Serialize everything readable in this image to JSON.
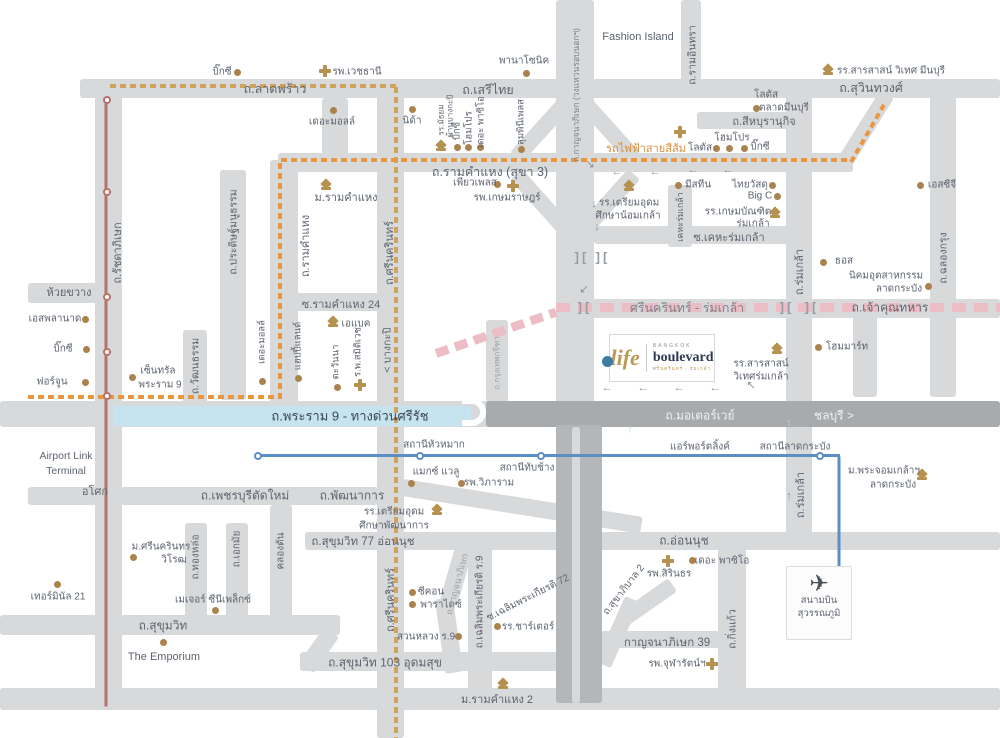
{
  "title": "Life Bangkok Boulevard Srinakarin-Romklao location map",
  "logo": {
    "brand_script": "life",
    "brand_city": "BANGKOK",
    "brand_name": "boulevard",
    "brand_sub": "ศรีนครินทร์ - ร่มเกล้า"
  },
  "airport": {
    "line1": "สนามบิน",
    "line2": "สุวรรณภูมิ",
    "plane_icon": "✈"
  },
  "palette": {
    "road": "#d8d9da",
    "roadDark": "#a7abad",
    "roadMid": "#b3b7b9",
    "hl": "#c5e4ef",
    "text": "#5d6470",
    "textLight": "#9aa0a6",
    "gold": "#a9824c",
    "icon": "#b5924f",
    "red": "#b5736b",
    "blue": "#5b8ec4",
    "yellow": "#cfa45f",
    "orange": "#e8963f",
    "pink": "#ecbdc4",
    "white": "#f0f1f2",
    "navy": "#2f3a50",
    "marker": "#3e7ca6"
  },
  "roads": [
    [
      80,
      79,
      920,
      19
    ],
    [
      681,
      0,
      20,
      88
    ],
    [
      858,
      88,
      16,
      80,
      32
    ],
    [
      697,
      112,
      108,
      17
    ],
    [
      556,
      0,
      38,
      430
    ],
    [
      532,
      95,
      16,
      72,
      42
    ],
    [
      602,
      95,
      16,
      72,
      -42
    ],
    [
      532,
      165,
      16,
      72,
      -42
    ],
    [
      602,
      165,
      16,
      72,
      42
    ],
    [
      278,
      153,
      575,
      19
    ],
    [
      95,
      79,
      27,
      631
    ],
    [
      220,
      170,
      26,
      230
    ],
    [
      183,
      330,
      24,
      73
    ],
    [
      270,
      160,
      28,
      243
    ],
    [
      377,
      79,
      27,
      659
    ],
    [
      28,
      283,
      82,
      20
    ],
    [
      284,
      293,
      110,
      18
    ],
    [
      322,
      98,
      26,
      58
    ],
    [
      594,
      226,
      212,
      18
    ],
    [
      668,
      185,
      24,
      62
    ],
    [
      786,
      95,
      26,
      450
    ],
    [
      930,
      95,
      26,
      302
    ],
    [
      853,
      315,
      24,
      82
    ],
    [
      556,
      299,
      444,
      19
    ],
    [
      486,
      320,
      22,
      82
    ],
    [
      0,
      401,
      505,
      26
    ],
    [
      28,
      487,
      350,
      18
    ],
    [
      390,
      497,
      253,
      17,
      9
    ],
    [
      305,
      532,
      695,
      18
    ],
    [
      185,
      523,
      22,
      108
    ],
    [
      226,
      523,
      22,
      108
    ],
    [
      270,
      505,
      22,
      126
    ],
    [
      0,
      615,
      340,
      20
    ],
    [
      310,
      628,
      18,
      44,
      35
    ],
    [
      300,
      652,
      262,
      19
    ],
    [
      468,
      545,
      24,
      150
    ],
    [
      448,
      542,
      18,
      62,
      16
    ],
    [
      440,
      598,
      18,
      75,
      -8
    ],
    [
      718,
      548,
      28,
      160
    ],
    [
      600,
      631,
      128,
      17
    ],
    [
      610,
      596,
      16,
      72,
      24
    ],
    [
      640,
      572,
      16,
      60,
      55
    ],
    [
      0,
      688,
      1000,
      22
    ],
    [
      486,
      401,
      514,
      26,
      0,
      "roadDark"
    ],
    [
      556,
      425,
      46,
      278,
      0,
      "roadMid"
    ],
    [
      572,
      427,
      8,
      276,
      0,
      "road"
    ],
    [
      113,
      406,
      358,
      20,
      0,
      "hl"
    ]
  ],
  "dashes": [
    {
      "x": 110,
      "y": 84,
      "len": 287,
      "rot": 0,
      "col": "yellow",
      "t": 4,
      "dash": 6,
      "gap": 4
    },
    {
      "x": 396,
      "y": 85,
      "len": 651,
      "rot": 90,
      "col": "yellow",
      "t": 4,
      "dash": 6,
      "gap": 4
    },
    {
      "x": 28,
      "y": 395,
      "len": 252,
      "rot": 0,
      "col": "orange",
      "t": 4,
      "dash": 6,
      "gap": 4
    },
    {
      "x": 280,
      "y": 161,
      "len": 237,
      "rot": 90,
      "col": "orange",
      "t": 4,
      "dash": 6,
      "gap": 4
    },
    {
      "x": 281,
      "y": 158,
      "len": 570,
      "rot": 0,
      "col": "orange",
      "t": 4,
      "dash": 6,
      "gap": 4
    },
    {
      "x": 851,
      "y": 160,
      "len": 70,
      "rot": -60,
      "col": "orange",
      "t": 4,
      "dash": 6,
      "gap": 4
    },
    {
      "x": 556,
      "y": 303,
      "len": 444,
      "rot": 0,
      "col": "pink",
      "t": 9,
      "dash": 14,
      "gap": 8
    },
    {
      "x": 436,
      "y": 349,
      "len": 127,
      "rot": -19,
      "col": "pink",
      "t": 9,
      "dash": 13,
      "gap": 7
    }
  ],
  "solids": [
    {
      "x": 106,
      "y": 97,
      "len": 608,
      "rot": 90,
      "col": "red",
      "t": 3
    },
    {
      "x": 258,
      "y": 454,
      "len": 582,
      "rot": 0,
      "col": "blue",
      "t": 3
    },
    {
      "x": 839,
      "y": 455,
      "len": 127,
      "rot": 90,
      "col": "blue",
      "t": 3
    }
  ],
  "stations": [
    {
      "x": 107,
      "y": 100,
      "col": "red"
    },
    {
      "x": 107,
      "y": 192,
      "col": "red"
    },
    {
      "x": 107,
      "y": 297,
      "col": "red"
    },
    {
      "x": 107,
      "y": 352,
      "col": "red"
    },
    {
      "x": 107,
      "y": 396,
      "col": "red"
    },
    {
      "x": 258,
      "y": 456,
      "col": "blue"
    },
    {
      "x": 420,
      "y": 456,
      "col": "blue"
    },
    {
      "x": 541,
      "y": 456,
      "col": "blue"
    },
    {
      "x": 820,
      "y": 456,
      "col": "blue"
    },
    {
      "x": 840,
      "y": 581,
      "col": "blue"
    }
  ],
  "dots": [
    [
      237,
      72
    ],
    [
      526,
      73
    ],
    [
      333,
      110
    ],
    [
      412,
      109
    ],
    [
      756,
      108
    ],
    [
      716,
      148
    ],
    [
      729,
      148
    ],
    [
      744,
      148
    ],
    [
      678,
      185
    ],
    [
      772,
      185
    ],
    [
      777,
      196
    ],
    [
      920,
      185
    ],
    [
      497,
      184
    ],
    [
      823,
      262
    ],
    [
      928,
      286
    ],
    [
      818,
      347
    ],
    [
      262,
      381
    ],
    [
      298,
      378
    ],
    [
      337,
      387
    ],
    [
      85,
      319
    ],
    [
      86,
      349
    ],
    [
      85,
      382
    ],
    [
      132,
      377
    ],
    [
      133,
      557
    ],
    [
      215,
      610
    ],
    [
      57,
      584
    ],
    [
      163,
      642
    ],
    [
      412,
      592
    ],
    [
      412,
      604
    ],
    [
      458,
      636
    ],
    [
      497,
      626
    ],
    [
      692,
      560
    ],
    [
      457,
      147
    ],
    [
      468,
      147
    ],
    [
      480,
      147
    ],
    [
      521,
      149
    ],
    [
      411,
      483
    ],
    [
      461,
      483
    ]
  ],
  "crosses": [
    [
      325,
      71
    ],
    [
      680,
      132
    ],
    [
      513,
      186
    ],
    [
      360,
      385
    ],
    [
      668,
      561
    ],
    [
      712,
      664
    ]
  ],
  "caps": [
    [
      326,
      186
    ],
    [
      629,
      187
    ],
    [
      775,
      214
    ],
    [
      441,
      147
    ],
    [
      333,
      323
    ],
    [
      828,
      71
    ],
    [
      777,
      350
    ],
    [
      922,
      476
    ],
    [
      437,
      511
    ],
    [
      503,
      685
    ]
  ],
  "arrows": [
    {
      "x": 617,
      "y": 172,
      "g": "←"
    },
    {
      "x": 655,
      "y": 172,
      "g": "←"
    },
    {
      "x": 693,
      "y": 170,
      "g": "←"
    },
    {
      "x": 728,
      "y": 170,
      "g": "←"
    },
    {
      "x": 590,
      "y": 164,
      "g": "↘"
    },
    {
      "x": 594,
      "y": 204,
      "g": "↓"
    },
    {
      "x": 597,
      "y": 227,
      "g": "↓"
    },
    {
      "x": 584,
      "y": 289,
      "g": "↙"
    },
    {
      "x": 607,
      "y": 388,
      "g": "←"
    },
    {
      "x": 643,
      "y": 388,
      "g": "←"
    },
    {
      "x": 679,
      "y": 388,
      "g": "←"
    },
    {
      "x": 715,
      "y": 388,
      "g": "←"
    },
    {
      "x": 751,
      "y": 385,
      "g": "↖"
    },
    {
      "x": 789,
      "y": 423,
      "g": "↑",
      "light": true
    },
    {
      "x": 630,
      "y": 429,
      "g": "↑",
      "light": true
    },
    {
      "x": 789,
      "y": 496,
      "g": "↑"
    }
  ],
  "brackets": [
    [
      582,
      257
    ],
    [
      603,
      257
    ],
    [
      585,
      307
    ],
    [
      787,
      307
    ],
    [
      812,
      307
    ]
  ],
  "uturn": {
    "x": 462,
    "y": 398,
    "w": 24,
    "h": 28
  },
  "marker": {
    "x": 607,
    "y": 361
  },
  "labels": [
    [
      "บิ๊กซี",
      222,
      72
    ],
    [
      "รพ.เวชธานี",
      357,
      72
    ],
    [
      "พานาโซนิค",
      524,
      61
    ],
    [
      "ถ.ลาดพร้าว",
      275,
      89,
      {
        "s": 12.5
      }
    ],
    [
      "ถ.เสรีไทย",
      488,
      90,
      {
        "s": 12.5
      }
    ],
    [
      "Fashion Island",
      638,
      37,
      {
        "s": 11
      }
    ],
    [
      "รร.สารสาสน์ วิเทศ มีนบุรี",
      891,
      71
    ],
    [
      "ถ.สุวินทวงศ์",
      871,
      88,
      {
        "s": 12.5
      }
    ],
    [
      "เดอะมอลล์",
      332,
      122
    ],
    [
      "นิด้า",
      412,
      121
    ],
    [
      "โลตัส",
      766,
      95
    ],
    [
      "ตลาดมีนบุรี",
      784,
      108
    ],
    [
      "ถ.สีหบุรานุกิจ",
      764,
      121,
      {
        "s": 11
      }
    ],
    [
      "โฮมโปร",
      732,
      138
    ],
    [
      "โลตัส",
      700,
      148
    ],
    [
      "บิ๊กซี",
      760,
      147
    ],
    [
      "รถไฟฟ้าสายสีส้ม",
      646,
      148,
      {
        "c": "#d98f3f",
        "s": 11
      }
    ],
    [
      "มีสทีน",
      698,
      185
    ],
    [
      "ไทยวัสดุ",
      750,
      185
    ],
    [
      "Big C",
      760,
      196
    ],
    [
      "เอสซีจี",
      942,
      185
    ],
    [
      "ถ.รามคำแหง (สุขา 3)",
      490,
      172,
      {
        "s": 12.5
      }
    ],
    [
      "เพียวเพลส",
      475,
      183
    ],
    [
      "รพ.เกษมราษฎร์",
      507,
      198
    ],
    [
      "ม.รามคำแหง",
      346,
      197,
      {
        "s": 11
      }
    ],
    [
      "รร.เตรียมอุดม",
      629,
      203
    ],
    [
      "ศึกษาน้อมเกล้า",
      628,
      216
    ],
    [
      "รร.เกษมบัณฑิต",
      738,
      212
    ],
    [
      "ร่มเกล้า",
      753,
      224
    ],
    [
      "ซ.เคหะร่มเกล้า",
      729,
      237,
      {
        "s": 11
      }
    ],
    [
      "ธอส",
      844,
      261
    ],
    [
      "นิคมอุตสาหกรรม",
      886,
      276
    ],
    [
      "ลาดกระบัง",
      899,
      289
    ],
    [
      "ห้วยขวาง",
      69,
      292,
      {
        "s": 11
      }
    ],
    [
      "ซ.รามคำแหง 24",
      341,
      304,
      {
        "s": 11
      }
    ],
    [
      "ศรีนครินทร์ - ร่มเกล้า",
      687,
      308,
      {
        "s": 12.5,
        "c": "#7d838c"
      }
    ],
    [
      "ถ.เจ้าคุณทหาร",
      890,
      308,
      {
        "s": 12
      }
    ],
    [
      "เอแบค",
      356,
      324
    ],
    [
      "เอสพลานาด",
      55,
      319
    ],
    [
      "บิ๊กซี",
      63,
      349
    ],
    [
      "ฟอร์จูน",
      52,
      382
    ],
    [
      "เซ็นทรัล",
      158,
      371
    ],
    [
      "พระราม 9",
      160,
      385
    ],
    [
      "โฮมมาร์ท",
      847,
      347
    ],
    [
      "รร.สารสาสน์",
      761,
      364
    ],
    [
      "วิเทศร่มเกล้า",
      761,
      377
    ],
    [
      "ถ.พระราม 9 - ทางด่วนศรีรัช",
      350,
      416,
      {
        "s": 13,
        "c": "#3d4854"
      }
    ],
    [
      "ถ.มอเตอร์เวย์",
      700,
      416,
      {
        "s": 12,
        "c": "#f0f1f2"
      }
    ],
    [
      "ชลบุรี >",
      834,
      416,
      {
        "s": 12,
        "c": "#f0f1f2"
      }
    ],
    [
      "Airport Link",
      66,
      456,
      {
        "s": 10.5
      }
    ],
    [
      "Terminal",
      66,
      471,
      {
        "s": 10.5
      }
    ],
    [
      "แอร์พอร์ตลิ้งค์",
      700,
      447
    ],
    [
      "สถานีลาดกระบัง",
      795,
      447
    ],
    [
      "สถานีหัวหมาก",
      434,
      445
    ],
    [
      "สถานีทับช้าง",
      527,
      468
    ],
    [
      "แมกซ์ แวลู",
      436,
      472
    ],
    [
      "รพ.วิภาราม",
      489,
      483
    ],
    [
      "อโศก",
      95,
      491,
      {
        "s": 11
      }
    ],
    [
      "ถ.เพชรบุรีตัดใหม่",
      245,
      496,
      {
        "s": 12
      }
    ],
    [
      "ถ.พัฒนาการ",
      352,
      496,
      {
        "s": 12
      }
    ],
    [
      "รร.เตรียมอุดม",
      394,
      512
    ],
    [
      "ศึกษาพัฒนาการ",
      394,
      526
    ],
    [
      "ม.พระจอมเกล้าฯ",
      884,
      471
    ],
    [
      "ลาดกระบัง",
      893,
      485
    ],
    [
      "ถ.สุขุมวิท 77 อ่อนนุช",
      363,
      542,
      {
        "s": 11.5
      }
    ],
    [
      "ม.ศรีนครินทร",
      161,
      547
    ],
    [
      "วิโรฒ",
      174,
      560
    ],
    [
      "ถ.อ่อนนุช",
      684,
      541,
      {
        "s": 12
      }
    ],
    [
      "เดอะ พาซิโอ",
      722,
      561
    ],
    [
      "รพ.สิรินธร",
      669,
      574
    ],
    [
      "เทอร์มินัล 21",
      58,
      597
    ],
    [
      "ซีคอน",
      431,
      592
    ],
    [
      "พาราไดซ์",
      441,
      605
    ],
    [
      "เมเจอร์ ซีนีเพล็กซ์",
      213,
      600
    ],
    [
      "ถ.สุขุมวิท",
      163,
      626,
      {
        "s": 12
      }
    ],
    [
      "สวนหลวง ร.9",
      426,
      637
    ],
    [
      "รร.ชาร์เตอร์",
      528,
      627
    ],
    [
      "The Emporium",
      164,
      657,
      {
        "s": 11
      }
    ],
    [
      "กาญจนาภิเษก 39",
      667,
      643,
      {
        "s": 11.5
      }
    ],
    [
      "รพ.จุฬารัตน์ฯ",
      677,
      664
    ],
    [
      "ถ.สุขุมวิท 103 อุดมสุข",
      385,
      663,
      {
        "s": 12
      }
    ],
    [
      "ม.รามคำแหง 2",
      497,
      699,
      {
        "s": 11
      }
    ],
    [
      "ถ.รัชดาภิเษก",
      117,
      253,
      {
        "r": -90,
        "s": 11
      }
    ],
    [
      "ถ.ประดิษฐ์มนูธรรม",
      233,
      232,
      {
        "r": -90,
        "s": 10.5
      }
    ],
    [
      "ถ.รามคำแหง",
      305,
      246,
      {
        "r": -90,
        "s": 11
      }
    ],
    [
      "ถ.ศรีนครินทร์",
      389,
      253,
      {
        "r": -90,
        "s": 11
      }
    ],
    [
      "< บางกะปิ",
      387,
      350,
      {
        "r": -90,
        "s": 10.5
      }
    ],
    [
      "ถ.วัฒนธรรม",
      195,
      366,
      {
        "r": -90,
        "s": 10.5
      }
    ],
    [
      "เดอะมอลล์",
      262,
      342,
      {
        "r": -90,
        "s": 9.5
      }
    ],
    [
      "แฮปปี้แลนด์",
      298,
      346,
      {
        "r": -90,
        "s": 9.5
      }
    ],
    [
      "ตะวันนา",
      336,
      362,
      {
        "r": -90,
        "s": 9.5
      }
    ],
    [
      "ร.พ.สมิติเวช",
      358,
      352,
      {
        "r": -90,
        "s": 9.5
      }
    ],
    [
      "รร.มัธยม",
      441,
      120,
      {
        "r": -90,
        "s": 8
      }
    ],
    [
      "บ้านบางกะปิ",
      450,
      116,
      {
        "r": -90,
        "s": 8
      }
    ],
    [
      "บิ๊กซี",
      457,
      131,
      {
        "r": -90,
        "s": 9.5
      }
    ],
    [
      "โฮมโปร",
      469,
      128,
      {
        "r": -90,
        "s": 9.5
      }
    ],
    [
      "เดอะ พาซิโอ",
      481,
      122,
      {
        "r": -90,
        "s": 9.5
      }
    ],
    [
      "ลุมพินีเพลส",
      521,
      122,
      {
        "r": -90,
        "s": 9.5
      }
    ],
    [
      "ถ.รามอินทรา",
      692,
      55,
      {
        "r": -90,
        "s": 10.5
      }
    ],
    [
      "ถ.กาญจนาภิเษก (วงแหวนรอบนอกฯ)",
      576,
      95,
      {
        "r": -90,
        "s": 8.5,
        "c": "#7d838c"
      }
    ],
    [
      "เคหะร่มเกล้า",
      680,
      217,
      {
        "r": -90,
        "s": 9
      }
    ],
    [
      "ถ.ร่มเกล้า",
      799,
      272,
      {
        "r": -90,
        "s": 11
      }
    ],
    [
      "ถ.ร่มเกล้า",
      800,
      495,
      {
        "r": -90,
        "s": 11
      }
    ],
    [
      "ถ.ฉลองกรุง",
      943,
      258,
      {
        "r": -90,
        "s": 10.5
      }
    ],
    [
      "ถ.ทองหล่อ",
      196,
      557,
      {
        "r": -90,
        "s": 10
      }
    ],
    [
      "ถ.เอกมัย",
      237,
      549,
      {
        "r": -90,
        "s": 10
      }
    ],
    [
      "คลองตัน",
      281,
      551,
      {
        "r": -90,
        "s": 10
      }
    ],
    [
      "ถ.ศรีนครินทร์",
      390,
      600,
      {
        "r": -90,
        "s": 11
      }
    ],
    [
      "ถ.เฉลิมพระเกียรติ ร.9",
      480,
      602,
      {
        "r": -90,
        "s": 10
      }
    ],
    [
      "ถ.กิ่งแก้ว",
      732,
      629,
      {
        "r": -90,
        "s": 10.5
      }
    ],
    [
      "ถ.กรุงเทพกรีฑา",
      497,
      363,
      {
        "r": -90,
        "s": 8,
        "c": "#9aa0a6"
      }
    ],
    [
      "ซ.เฉลิมพระเกียรติ 72",
      528,
      598,
      {
        "r": -27,
        "s": 10
      }
    ],
    [
      "ถ.สุขาภิบาล 2",
      624,
      590,
      {
        "r": -52,
        "s": 10
      }
    ],
    [
      "ถ.กาญจนาภิเษก",
      457,
      584,
      {
        "r": -75,
        "s": 9,
        "c": "#9aa0a6"
      }
    ]
  ]
}
